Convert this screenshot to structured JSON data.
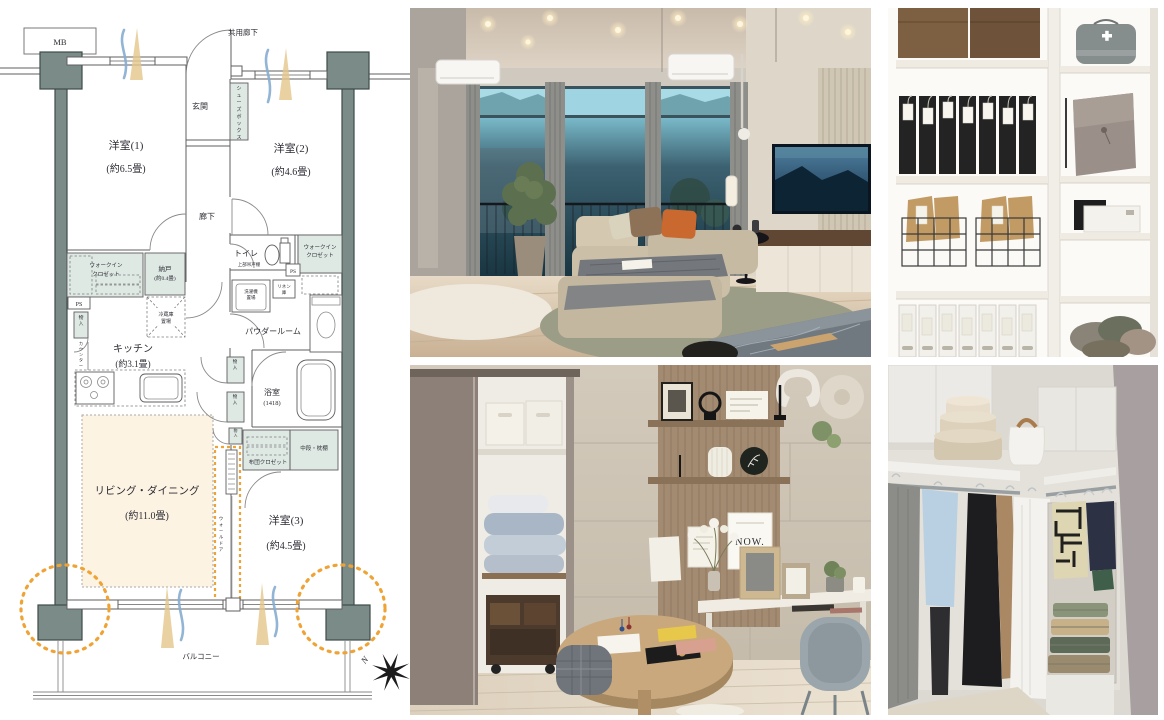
{
  "fp": {
    "mb": "MB",
    "common_corridor": "共用廊下",
    "entrance": "玄関",
    "shoe_box": "シューズボックス",
    "room1_name": "洋室(1)",
    "room1_size": "(約6.5畳)",
    "room2_name": "洋室(2)",
    "room2_size": "(約4.6畳)",
    "room3_name": "洋室(3)",
    "room3_size": "(約4.5畳)",
    "corridor": "廊下",
    "wic1": "ウォークイン",
    "wic2": "クロゼット",
    "nando_name": "納戸",
    "nando_size": "(約0.4畳)",
    "toilet": "トイレ",
    "toilet_note": "上部吊戸棚",
    "ps": "PS",
    "washer1": "洗濯機",
    "washer2": "置場",
    "linen1": "リネン",
    "linen2": "庫",
    "monoire": "物入",
    "counter": "カウンター",
    "fridge1": "冷蔵庫",
    "fridge2": "置場",
    "kitchen_name": "キッチン",
    "kitchen_size": "(約3.1畳)",
    "powder": "パウダールーム",
    "bath_name": "浴室",
    "bath_size": "(1418)",
    "shelf_label": "中段・枕棚",
    "futon_label": "布団クロゼット",
    "ld_name": "リビング・ダイニング",
    "ld_size": "(約11.0畳)",
    "wall_door": "ウォールドア",
    "balcony": "バルコニー",
    "north": "N"
  },
  "photos": {
    "desk": {
      "card": "NOW."
    }
  },
  "colors": {
    "accent_orange": "#F0A335",
    "pillar": "#7A8B88",
    "closet_fill": "#DFE9E4",
    "living_fill": "#FDF3E2",
    "wind_blue": "#86ADD0",
    "light_beam": "#E5C689"
  }
}
